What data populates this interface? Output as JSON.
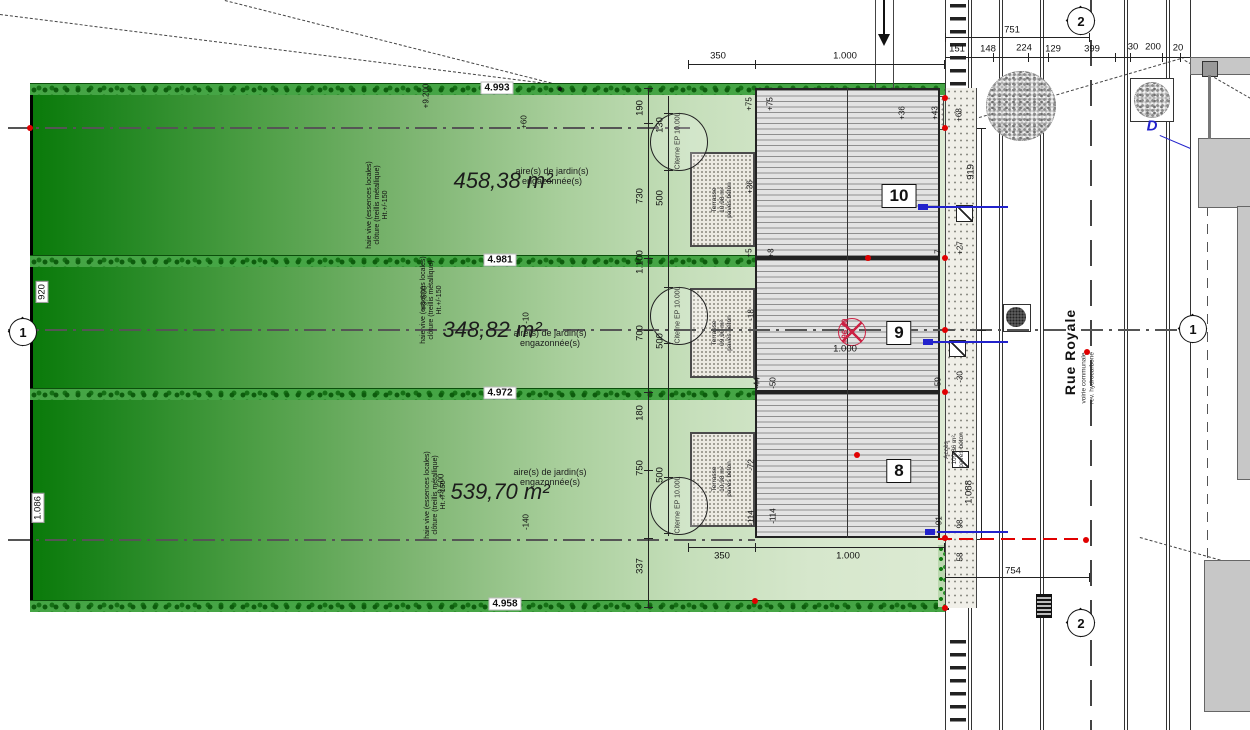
{
  "colors": {
    "parcel_dark": "#0a7a0a",
    "parcel_light": "#dcead3",
    "hedge": "#157015",
    "building_fill": "#e3e3e3",
    "accent_red": "#e10000",
    "level_red": "#cc2244",
    "accent_blue": "#2222cc"
  },
  "parcels": [
    {
      "area": "458,38 m²",
      "note1": "aire(s) de jardin(s)",
      "note2": "engazonnée(s)",
      "hedge_dim": "4.993"
    },
    {
      "area": "348,82 m²",
      "note1": "aire(s) de jardin(s)",
      "note2": "engazonnée(s)",
      "hedge_dim": "4.981"
    },
    {
      "area": "539,70 m²",
      "note1": "aire(s) de jardin(s)",
      "note2": "engazonnée(s)",
      "hedge_dim": "4.972"
    }
  ],
  "hedge_bottom_label": "4.958",
  "edge_dims": {
    "left_top": "920",
    "left_bottom": "1.086"
  },
  "haie_note": {
    "l1": "haie vive (essences locales)",
    "l2": "clôture (treillis métallique)",
    "l3": "Ht.+/-150"
  },
  "buildings": [
    {
      "number": "10",
      "terrace": {
        "l1": "Terrasse",
        "l2": "10,98 m²",
        "l3": "pavés béton"
      }
    },
    {
      "number": "9",
      "terrace": {
        "l1": "Terrasse",
        "l2": "09,90 m²",
        "l3": "pavés béton"
      }
    },
    {
      "number": "8",
      "terrace": {
        "l1": "Terrasse",
        "l2": "10,98 m²",
        "l3": "pavés béton"
      }
    }
  ],
  "citerne_label": "Citerne EP 10.00L",
  "access_note": {
    "l1": "Accès",
    "l2": "109,86 m²",
    "l3": "pavés béton"
  },
  "street": {
    "name": "Rue Royale",
    "surface1": "voirie communale",
    "surface2": "rev. hydrocarboné"
  },
  "grid_markers": {
    "left": "1",
    "right": "1",
    "top": "2",
    "bottom": "2"
  },
  "level_mark": {
    "value": "+96.40",
    "dim": "1.000"
  },
  "blue_label": "D",
  "dims": [
    {
      "label": "350",
      "x": 718,
      "y": 56
    },
    {
      "label": "1.000",
      "x": 845,
      "y": 56
    },
    {
      "label": "751",
      "x": 1012,
      "y": 30
    },
    {
      "label": "151",
      "x": 957,
      "y": 49
    },
    {
      "label": "148",
      "x": 988,
      "y": 49
    },
    {
      "label": "224",
      "x": 1024,
      "y": 48
    },
    {
      "label": "129",
      "x": 1053,
      "y": 49
    },
    {
      "label": "399",
      "x": 1092,
      "y": 49
    },
    {
      "label": "30",
      "x": 1133,
      "y": 47
    },
    {
      "label": "200",
      "x": 1153,
      "y": 47
    },
    {
      "label": "20",
      "x": 1178,
      "y": 48
    },
    {
      "label": "350",
      "x": 722,
      "y": 556
    },
    {
      "label": "1.000",
      "x": 848,
      "y": 556
    },
    {
      "label": "754",
      "x": 1013,
      "y": 571
    },
    {
      "label": "190",
      "x": 640,
      "y": 108,
      "cls": "v"
    },
    {
      "label": "730",
      "x": 640,
      "y": 196,
      "cls": "v"
    },
    {
      "label": "1.100",
      "x": 640,
      "y": 262,
      "cls": "v"
    },
    {
      "label": "700",
      "x": 640,
      "y": 333,
      "cls": "v"
    },
    {
      "label": "180",
      "x": 640,
      "y": 413,
      "cls": "v"
    },
    {
      "label": "750",
      "x": 640,
      "y": 468,
      "cls": "v"
    },
    {
      "label": "337",
      "x": 640,
      "y": 566,
      "cls": "v"
    },
    {
      "label": "130",
      "x": 660,
      "y": 125,
      "cls": "v"
    },
    {
      "label": "500",
      "x": 660,
      "y": 198,
      "cls": "v"
    },
    {
      "label": "500",
      "x": 660,
      "y": 341,
      "cls": "v"
    },
    {
      "label": "500",
      "x": 660,
      "y": 475,
      "cls": "v"
    },
    {
      "label": "919",
      "x": 971,
      "y": 172,
      "cls": "v"
    },
    {
      "label": "1.088",
      "x": 969,
      "y": 492,
      "cls": "v"
    }
  ],
  "elevations": [
    {
      "label": "+75",
      "x": 749,
      "y": 104,
      "cls": "v"
    },
    {
      "label": "+75",
      "x": 770,
      "y": 104,
      "cls": "v"
    },
    {
      "label": "+36",
      "x": 750,
      "y": 187,
      "cls": "v"
    },
    {
      "label": "+5",
      "x": 749,
      "y": 253,
      "cls": "v"
    },
    {
      "label": "+8",
      "x": 771,
      "y": 253,
      "cls": "v"
    },
    {
      "label": "-7",
      "x": 938,
      "y": 253,
      "cls": "v"
    },
    {
      "label": "+27",
      "x": 960,
      "y": 248,
      "cls": "v"
    },
    {
      "label": "+36",
      "x": 902,
      "y": 113,
      "cls": "v"
    },
    {
      "label": "+43",
      "x": 935,
      "y": 113,
      "cls": "v"
    },
    {
      "label": "+68",
      "x": 959,
      "y": 115,
      "cls": "v"
    },
    {
      "label": "-18",
      "x": 751,
      "y": 315,
      "cls": "v"
    },
    {
      "label": "-44",
      "x": 757,
      "y": 383,
      "cls": "v"
    },
    {
      "label": "-50",
      "x": 773,
      "y": 383,
      "cls": "v"
    },
    {
      "label": "-59",
      "x": 938,
      "y": 383,
      "cls": "v"
    },
    {
      "label": "-30",
      "x": 960,
      "y": 377,
      "cls": "v"
    },
    {
      "label": "-72",
      "x": 751,
      "y": 465,
      "cls": "v"
    },
    {
      "label": "-114",
      "x": 751,
      "y": 518,
      "cls": "v"
    },
    {
      "label": "-114",
      "x": 773,
      "y": 516,
      "cls": "v"
    },
    {
      "label": "-91",
      "x": 939,
      "y": 522,
      "cls": "v"
    },
    {
      "label": "98",
      "x": 960,
      "y": 524,
      "cls": "v"
    },
    {
      "label": "58",
      "x": 960,
      "y": 557,
      "cls": "v"
    },
    {
      "label": "+60",
      "x": 524,
      "y": 122,
      "cls": "v"
    },
    {
      "label": "-10",
      "x": 526,
      "y": 318,
      "cls": "v"
    },
    {
      "label": "-140",
      "x": 526,
      "y": 522,
      "cls": "v"
    },
    {
      "label": "+9.200",
      "x": 426,
      "y": 96,
      "cls": "v red"
    },
    {
      "label": "+9.600",
      "x": 424,
      "y": 298,
      "cls": "v red"
    },
    {
      "label": "+9.500",
      "x": 441,
      "y": 486,
      "cls": "v red"
    }
  ]
}
